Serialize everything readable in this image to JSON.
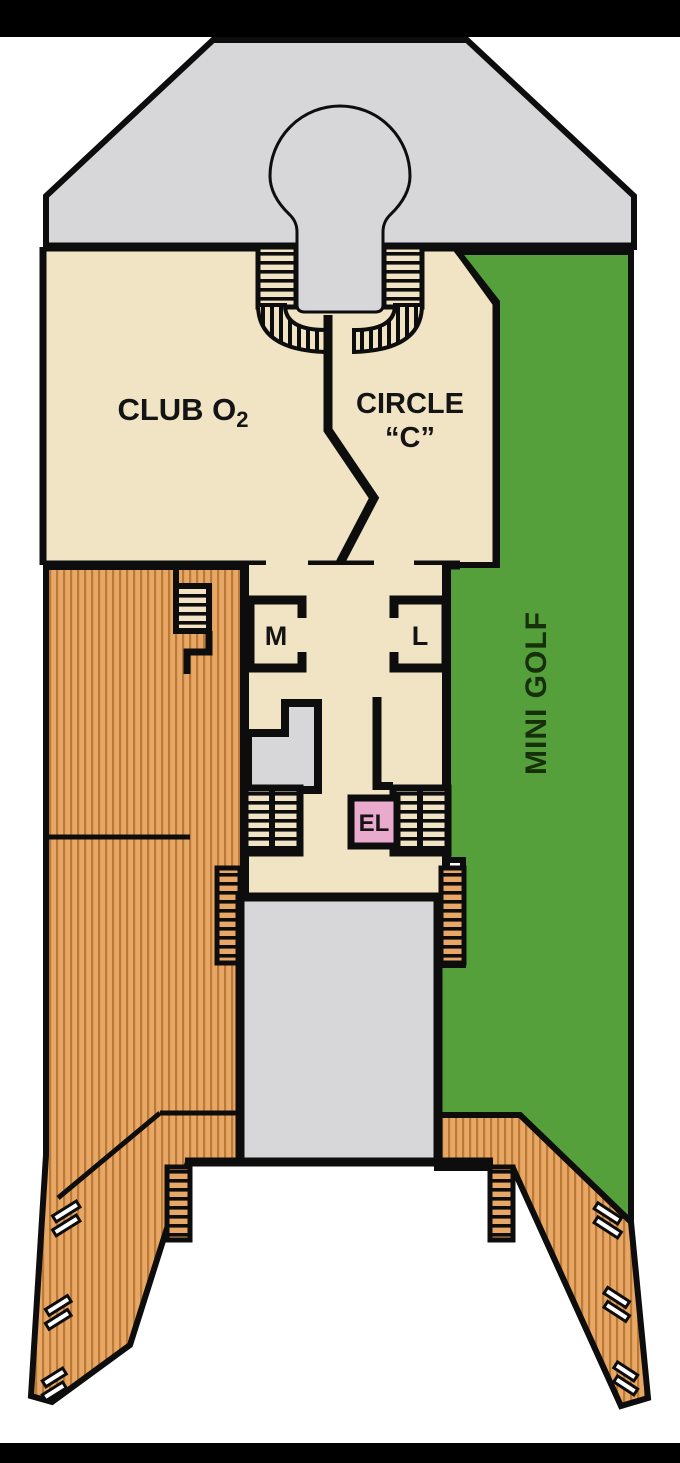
{
  "title": "Cruise ship deck plan - sports deck",
  "colors": {
    "canvas_black": "#000000",
    "page_white": "#ffffff",
    "deck_gray": "#d7d7d9",
    "room_beige": "#f0e4c5",
    "golf_green": "#55a03a",
    "wood": "#e9a765",
    "wood_stripe": "#b97a38",
    "rung_black": "#0d0d0d",
    "elevator_pink": "#e9aacd",
    "outline": "#0d0d0d",
    "label_dark": "#141414",
    "golf_label": "#15300b"
  },
  "labels": {
    "club_o2_main": "CLUB O",
    "club_o2_sub": "2",
    "circle_c_line1": "CIRCLE",
    "circle_c_line2": "“C”",
    "mens_room": "M",
    "ladies_room": "L",
    "elevator": "EL",
    "mini_golf": "MINI GOLF"
  }
}
